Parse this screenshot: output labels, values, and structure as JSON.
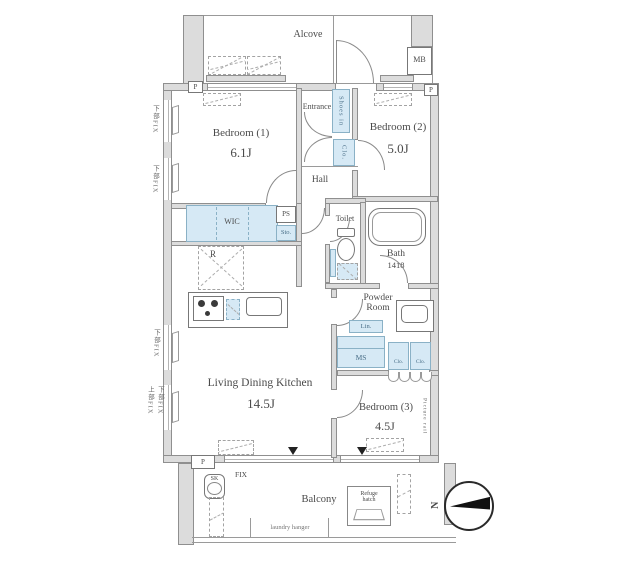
{
  "colors": {
    "wall_fill": "#dcdcdc",
    "wall_border": "#8f8f8f",
    "closet_fill": "#d6e9f5",
    "closet_border": "#8ab1c6",
    "text": "#4a4a4a",
    "compass_fill": "#111111"
  },
  "labels": {
    "alcove": "Alcove",
    "mb": "MB",
    "p_top_left": "P",
    "p_top_right": "P",
    "p_balcony": "P",
    "entrance": "Entrance",
    "shoes_in": "Shoes in",
    "entrance_closet": "Clo.",
    "bedroom1_name": "Bedroom (1)",
    "bedroom1_size": "6.1J",
    "bedroom2_name": "Bedroom (2)",
    "bedroom2_size": "5.0J",
    "hall": "Hall",
    "wic": "WIC",
    "ps": "PS",
    "sto": "Sto.",
    "fridge": "R",
    "toilet": "Toilet",
    "bath_name": "Bath",
    "bath_size": "1418",
    "powder_line1": "Powder",
    "powder_line2": "Room",
    "lin": "Lin.",
    "ms": "MS",
    "clo_a": "Clo.",
    "clo_b": "Clo.",
    "ldk_name": "Living Dining Kitchen",
    "ldk_size": "14.5J",
    "bedroom3_name": "Bedroom (3)",
    "bedroom3_size": "4.5J",
    "picture_rail": "Picture rail",
    "balcony": "Balcony",
    "laundry_hanger": "laundry hanger",
    "fix": "FIX",
    "sk": "SK",
    "refuge_line1": "Refuge",
    "refuge_line2": "hatch",
    "compass_n": "N",
    "wall_note_1": "下部FIX",
    "wall_note_2": "下部FIX",
    "wall_note_3": "下部FIX",
    "wall_note_4": "上部FIX",
    "wall_note_5": "下部FIX"
  }
}
